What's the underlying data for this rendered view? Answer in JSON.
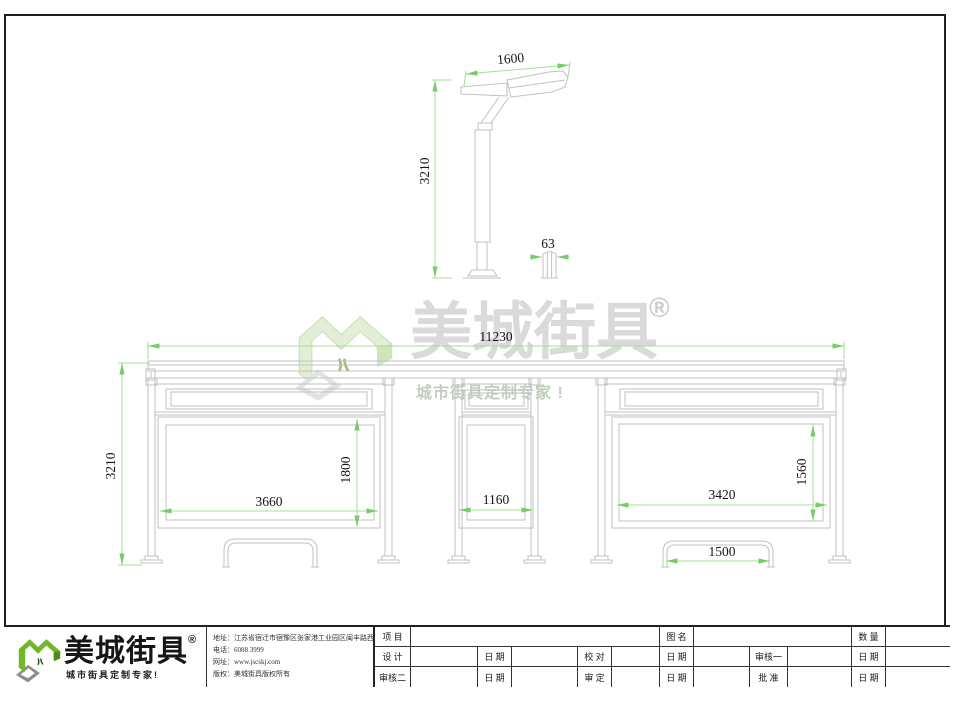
{
  "colors": {
    "line_gray": "#c1c1c1",
    "dim_green": "#9fe093",
    "arrow_green": "#76cc69",
    "brand_green": "#72b62c",
    "brand_green_dark": "#4e8c1a",
    "shadow_gray": "#8e8e8e",
    "watermark_gray": "#dadada",
    "watermark_pale_green": "#e3eed6"
  },
  "lamp": {
    "width_dim": "1600",
    "height_dim": "3210",
    "bollard_dim": "63"
  },
  "shelter": {
    "total_width_dim": "11230",
    "height_dim": "3210",
    "left_panel_width_dim": "3660",
    "left_panel_height_dim": "1800",
    "middle_panel_width_dim": "1160",
    "right_panel_width_dim": "3420",
    "right_panel_height_dim": "1560",
    "bench_width_dim": "1500"
  },
  "watermark": {
    "brand": "美城街具",
    "registered_mark": "®",
    "tagline": "城市街具定制专家 !"
  },
  "footer": {
    "logo": {
      "brand": "美城街具",
      "registered_mark": "®",
      "tagline": "城市街具定制专家!"
    },
    "contact": {
      "address": "地址：江苏省宿迁市宿豫区张家港工业园区闽丰路西侧1号",
      "phone": "电话：6088 3999",
      "website": "网址：www.jscskj.com",
      "copyright": "版权：美城街具版权所有"
    },
    "title_block": {
      "row1": [
        "项 目",
        "",
        "图 名",
        "",
        "数 量",
        ""
      ],
      "row2": [
        "设 计",
        "",
        "日 期",
        "",
        "校 对",
        "",
        "日 期",
        "",
        "审核一",
        "",
        "日 期",
        ""
      ],
      "row3": [
        "审核二",
        "",
        "日 期",
        "",
        "审 定",
        "",
        "日 期",
        "",
        "批 准",
        "",
        "日 期",
        ""
      ]
    }
  }
}
